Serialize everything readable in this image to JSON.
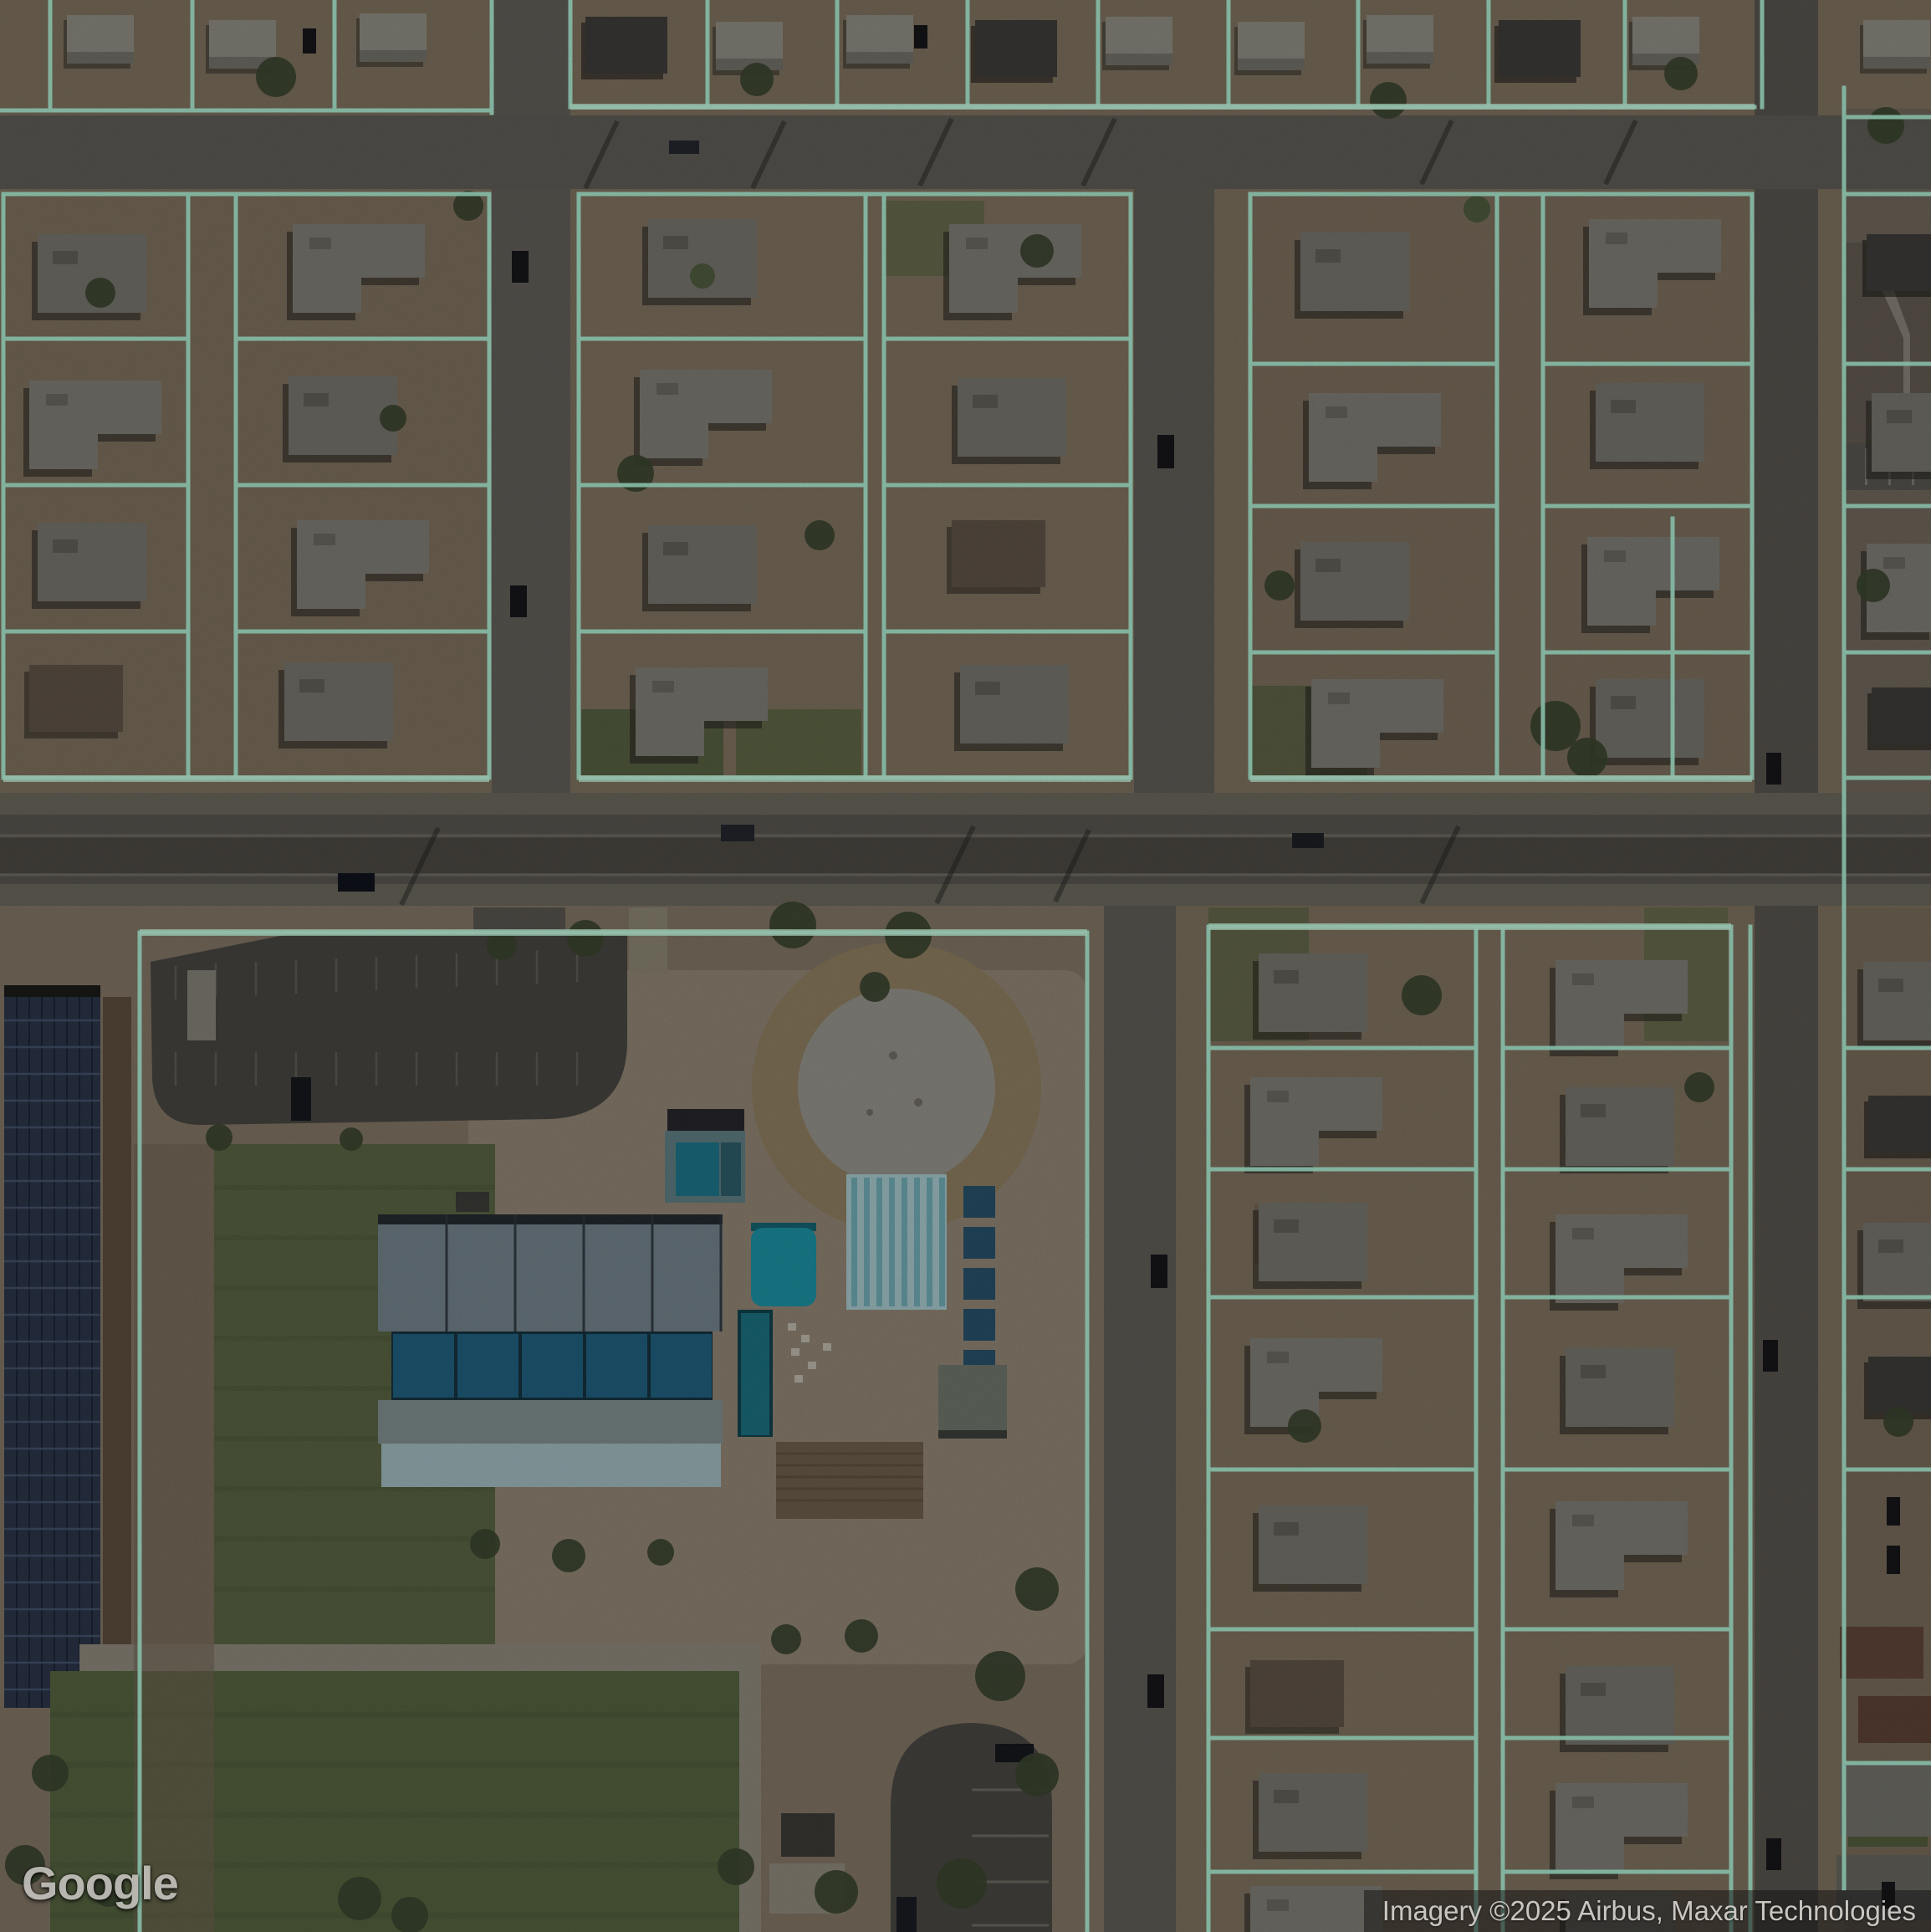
{
  "view": {
    "kind": "satellite-imagery-with-parcel-overlay",
    "scene": "suburban residential blocks, arterial road, community park with aquatic center"
  },
  "watermark": {
    "text": "Google"
  },
  "attribution": {
    "text": "Imagery ©2025 Airbus, Maxar Technologies"
  },
  "colors": {
    "ground": "#7a6e5d",
    "block_dirt": "#7b6e5c",
    "road": "#5d5a54",
    "arterial": "#56534d",
    "arterial_center": "#4a4741",
    "parcel_line": "#a8ead0",
    "parcel_line_bright": "#c2f3da",
    "grass": "#566140",
    "deck": "#8d8171",
    "parking_lot": "#45433f",
    "solar_panel": "#2a3347",
    "pool_teal": "#1b8d9e",
    "lap_pool": "#a3c3c7",
    "courts": "#1f5e7c",
    "roof_gray": "#73716a",
    "roof_light": "#8b897f",
    "roof_dark": "#3c3b38",
    "roof_brown": "#5c5145",
    "tree": "#38422e"
  },
  "legend": {
    "overlay_meaning": "parcel-boundaries",
    "map_features": [
      "residential-parcels",
      "arterial-road",
      "local-streets",
      "community-park",
      "aquatic-center-pools",
      "sport-courts",
      "solar-canopy",
      "lawns",
      "parking-areas"
    ]
  }
}
